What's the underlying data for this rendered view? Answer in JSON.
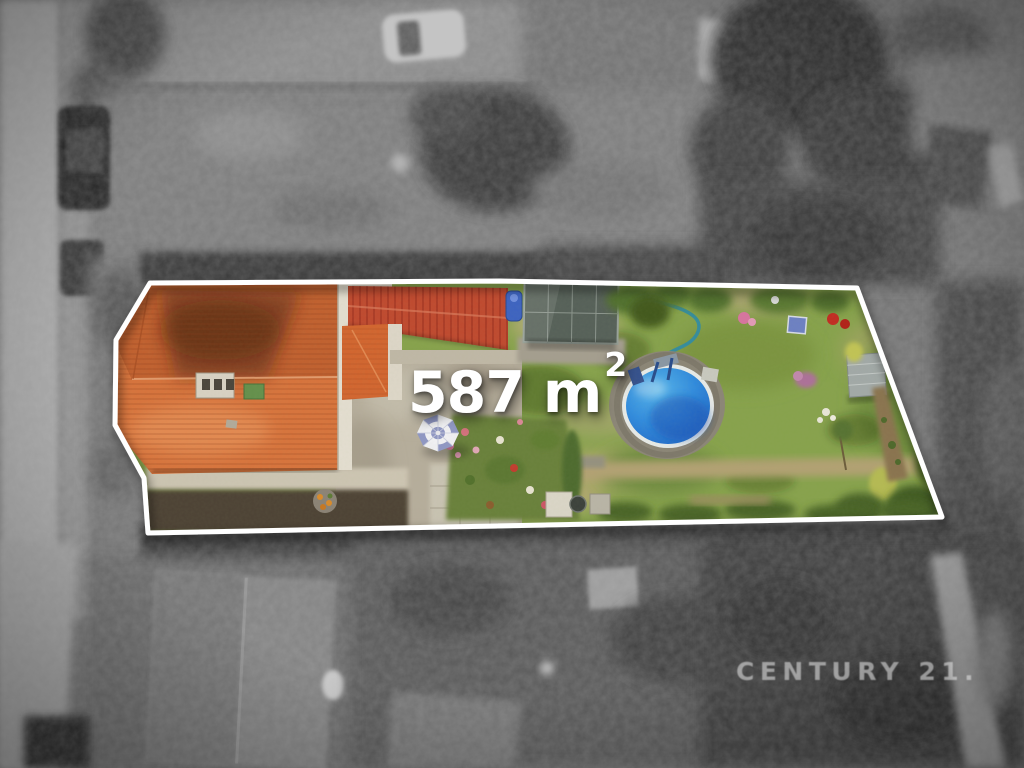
{
  "overlay": {
    "area_label": "587 m",
    "area_superscript": "2",
    "watermark": "CENTURY 21."
  },
  "colors": {
    "outline": "#ffffff",
    "area_text": "#ffffff",
    "watermark_text": "rgba(234,234,234,0.55)",
    "lawn_green": "#87a24c",
    "courtyard_gray": "#b6ad9c",
    "roof_tile": "#d8733c",
    "roof_tile_shade": "#c2602f",
    "roof_red": "#c0492f",
    "pool_light": "#55b4ec",
    "pool_mid": "#2f8ade",
    "pool_deep": "#1d5fc2",
    "umbrella_blue": "#9097c5"
  }
}
